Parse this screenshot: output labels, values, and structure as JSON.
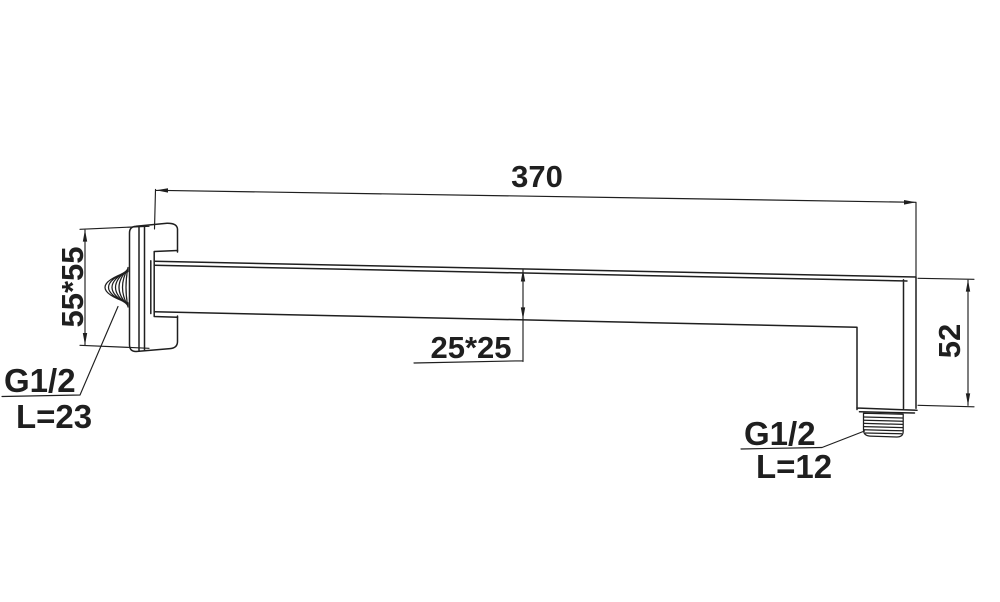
{
  "colors": {
    "line": "#1f1f1f",
    "background": "#ffffff"
  },
  "annotations": {
    "arm_length": "370",
    "flange_size": "55*55",
    "arm_section": "25*25",
    "outlet_drop": "52",
    "wall_thread_spec": "G1/2",
    "wall_thread_length": "L=23",
    "outlet_thread_spec": "G1/2",
    "outlet_thread_length": "L=12"
  }
}
